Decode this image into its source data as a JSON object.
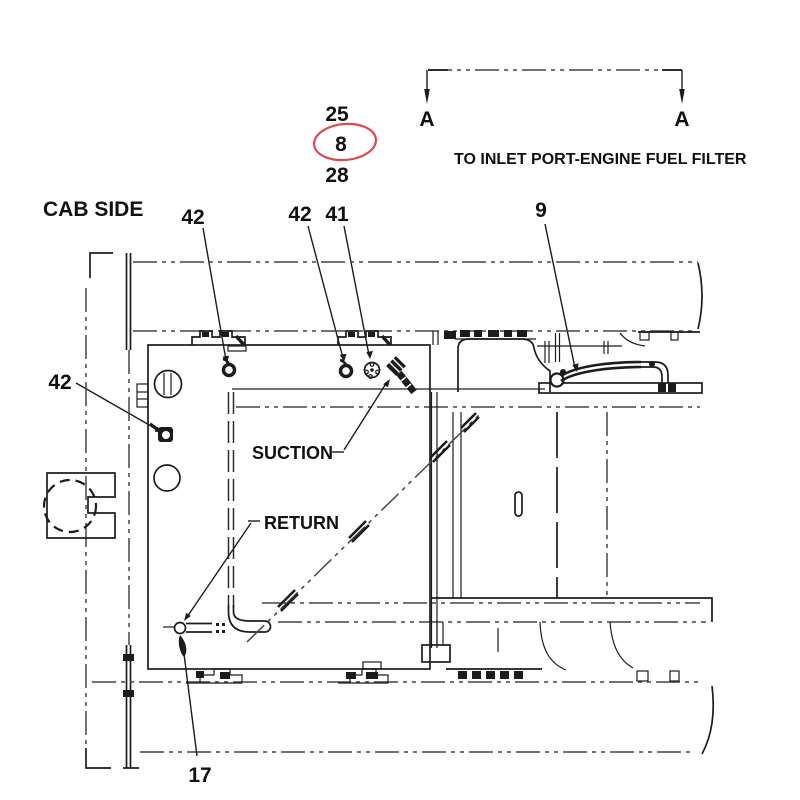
{
  "diagram": {
    "note": "TO INLET PORT-ENGINE FUEL FILTER",
    "cab_side_label": "CAB SIDE",
    "suction_label": "SUCTION",
    "return_label": "RETURN",
    "section_marker_left": "A",
    "section_marker_right": "A",
    "callouts": {
      "c25": "25",
      "c8": "8",
      "c28": "28",
      "c42_top_left": "42",
      "c42_top_mid": "42",
      "c41": "41",
      "c9": "9",
      "c42_left": "42",
      "c17": "17"
    },
    "highlighted_callout": "8",
    "colors": {
      "line": "#1c1c1c",
      "centerline": "#454545",
      "highlight": "#e0474d"
    }
  }
}
